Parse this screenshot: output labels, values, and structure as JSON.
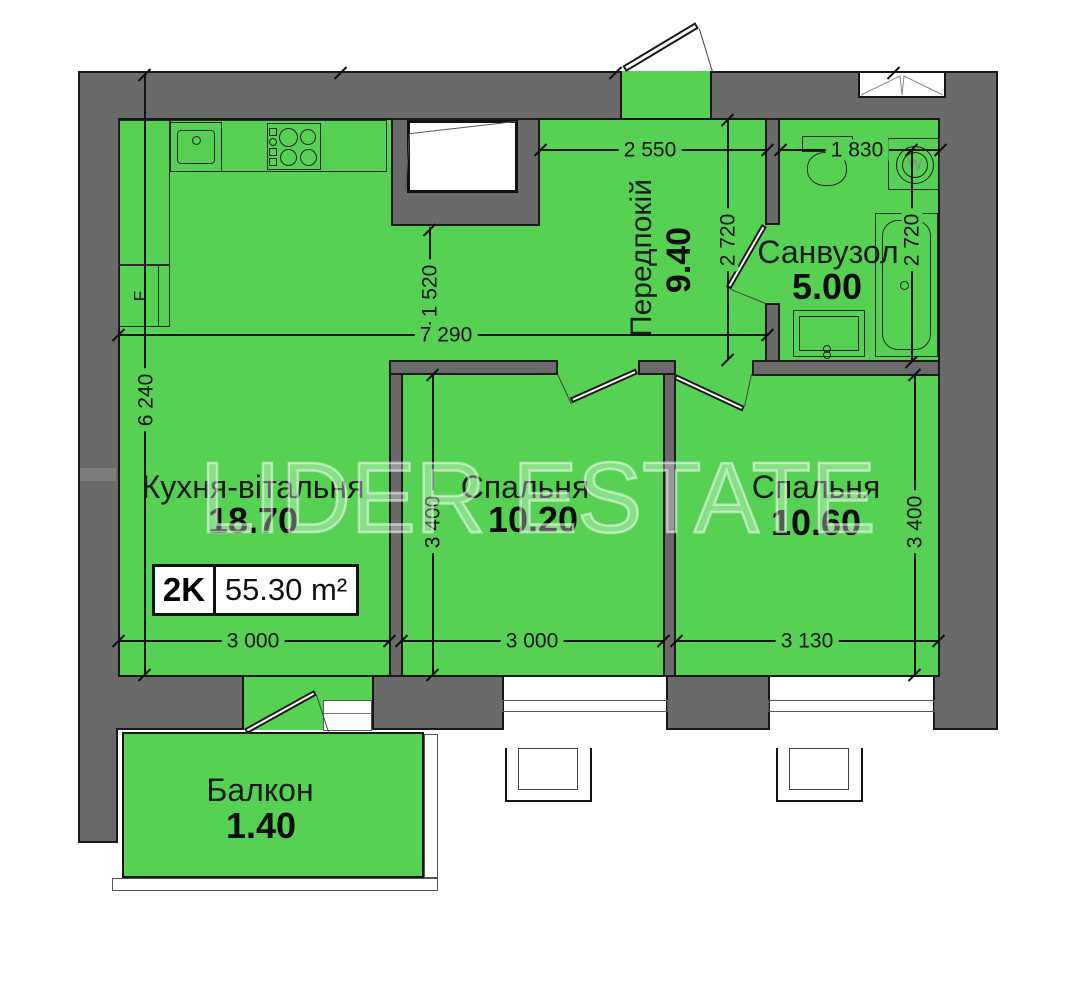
{
  "watermark": {
    "text": "LIDER ESTATE"
  },
  "badge": {
    "rooms_label": "2K",
    "total_area": "55.30 m²"
  },
  "rooms": {
    "kitchen": {
      "name": "Кухня-вітальня",
      "area": "18.70"
    },
    "bedroom1": {
      "name": "Спальня",
      "area": "10.20"
    },
    "bedroom2": {
      "name": "Спальня",
      "area": "10.60"
    },
    "hallway": {
      "name": "Передпокій",
      "area": "9.40"
    },
    "bathroom": {
      "name": "Санвузол",
      "area": "5.00"
    },
    "balcony": {
      "name": "Балкон",
      "area": "1.40"
    }
  },
  "dimensions": {
    "hall_width": "2 550",
    "bath_width": "1 830",
    "hall_height": "2 720",
    "bath_height": "2 720",
    "niche_offset": "1 520",
    "total_width": "7 290",
    "kitchen_height": "6 240",
    "kitchen_width": "3 000",
    "bedroom1_width": "3 000",
    "bedroom2_width": "3 130",
    "bedroom1_height": "3 400",
    "bedroom2_height": "3 400"
  },
  "appliances": {
    "fridge_label": "F",
    "washer_label": "W"
  },
  "colors": {
    "room_green": "#56d154",
    "wall_gray": "#6a6a6a"
  }
}
